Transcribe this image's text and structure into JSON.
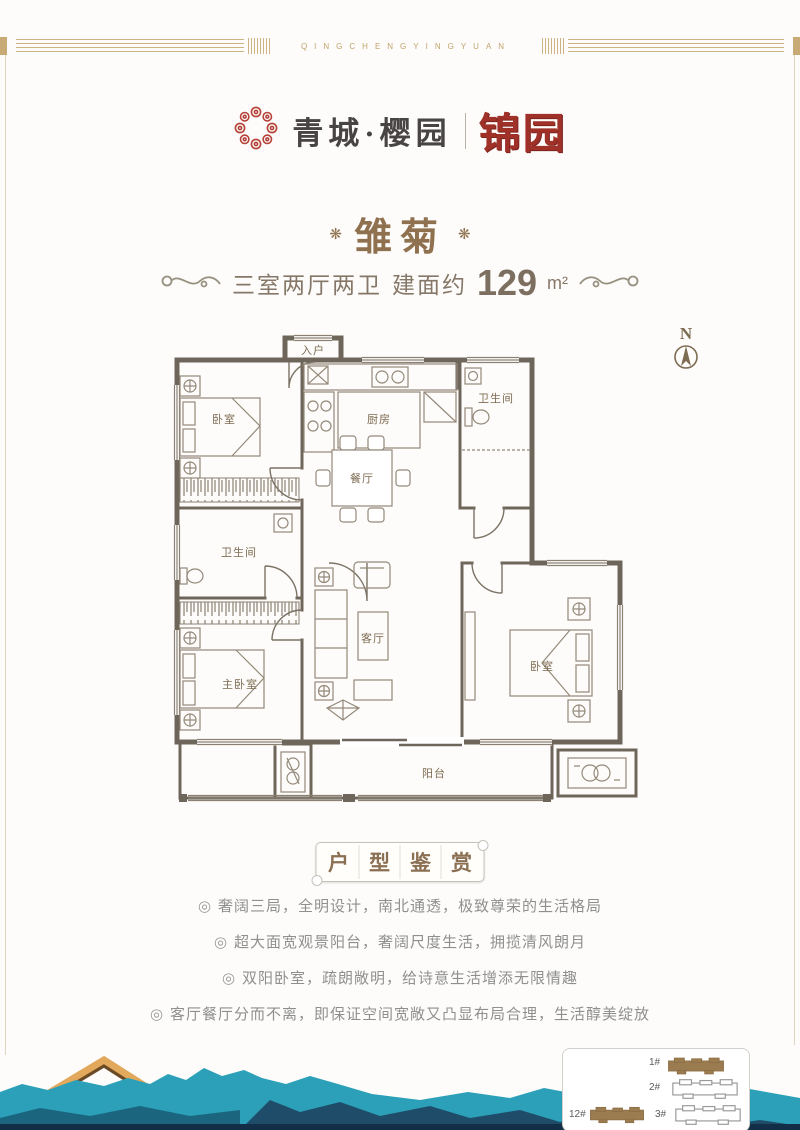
{
  "top_banner": {
    "text": "QINGCHENGYINGYUAN"
  },
  "logo": {
    "name": "青城·樱园",
    "sub": "锦园",
    "wreath_color": "#b5423a"
  },
  "unit": {
    "ornament_left": "❋",
    "ornament_right": "❋",
    "title": "雏菊"
  },
  "subtitle": {
    "rooms": "三室两厅两卫",
    "area_prefix": "建面约",
    "area_value": "129",
    "area_unit": "m²"
  },
  "compass": {
    "label": "N"
  },
  "floorplan": {
    "rooms": [
      {
        "name": "entry",
        "label": "入户"
      },
      {
        "name": "bedroom-north",
        "label": "卧室"
      },
      {
        "name": "kitchen",
        "label": "厨房"
      },
      {
        "name": "bath-north",
        "label": "卫生间"
      },
      {
        "name": "dining",
        "label": "餐厅"
      },
      {
        "name": "bath-west",
        "label": "卫生间"
      },
      {
        "name": "living",
        "label": "客厅"
      },
      {
        "name": "master-bedroom",
        "label": "主卧室"
      },
      {
        "name": "bedroom-east",
        "label": "卧室"
      },
      {
        "name": "balcony",
        "label": "阳台"
      }
    ]
  },
  "banner": {
    "chars": [
      "户",
      "型",
      "鉴",
      "赏"
    ]
  },
  "features": {
    "marker": "◎",
    "items": [
      "奢阔三局，全明设计，南北通透，极致尊荣的生活格局",
      "超大面宽观景阳台，奢阔尺度生活，拥揽清风朗月",
      "双阳卧室，疏朗敞明，给诗意生活增添无限情趣",
      "客厅餐厅分而不离，即保证空间宽敞又凸显布局合理，生活醇美绽放"
    ]
  },
  "siteplan": {
    "buildings": [
      {
        "label": "1#",
        "highlight": true
      },
      {
        "label": "2#",
        "highlight": false
      },
      {
        "label": "12#",
        "highlight": true
      },
      {
        "label": "3#",
        "highlight": false
      }
    ]
  },
  "colors": {
    "accent_red": "#a03129",
    "gold": "#c8ab74",
    "title_brown": "#8f7150",
    "plan_wall": "#6e665a",
    "teal": "#2ba0b8",
    "navy": "#1e4460",
    "building_fill": "#9b7b50"
  }
}
